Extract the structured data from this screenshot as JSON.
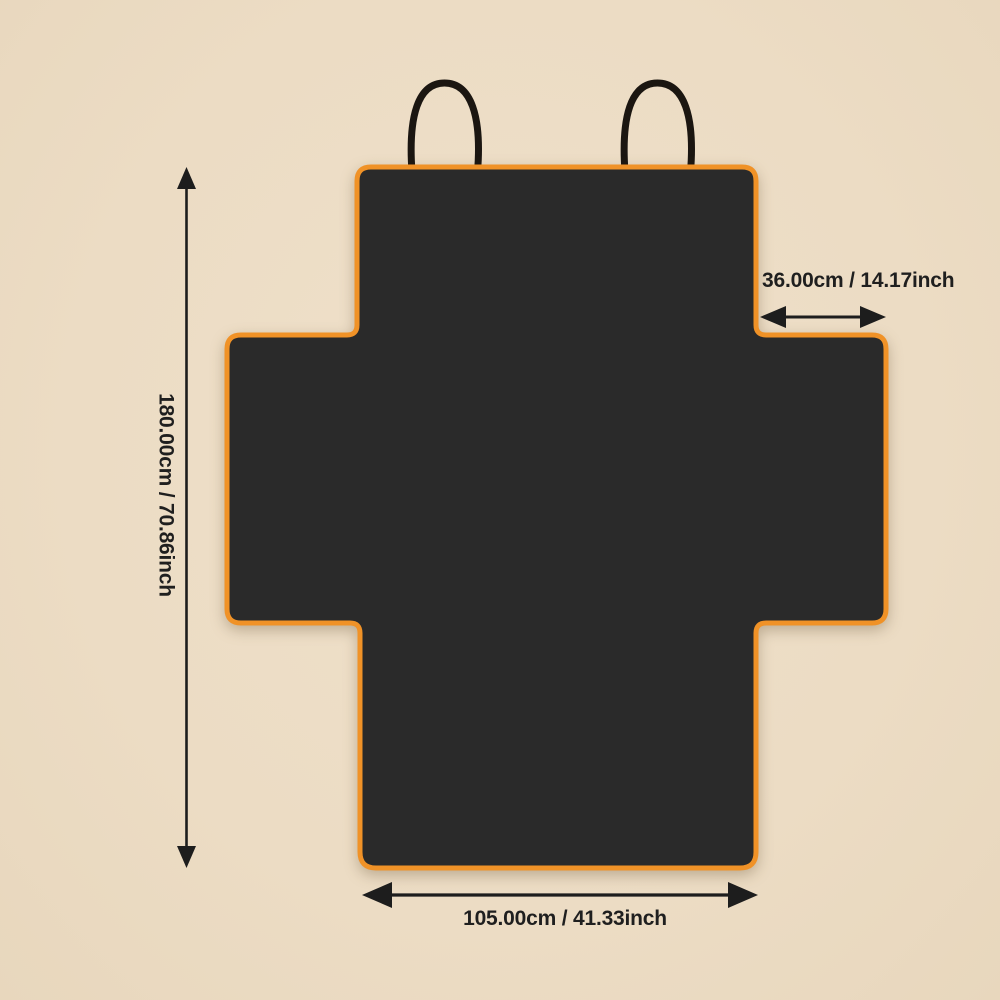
{
  "page": {
    "background_color": "#ecdcc4",
    "content_type": "product-dimension-diagram"
  },
  "product_diagram": {
    "shape": "cross-shaped seat cover with two top hanging loops",
    "straps_count": 2,
    "colors": {
      "cover_fill": "#2a2a2a",
      "trim": "#f09227",
      "strap": "#1b1611",
      "dimension_ink": "#1d1d1d",
      "background": "#ecdcc4"
    }
  },
  "dimensions": {
    "height": {
      "label": "180.00cm / 70.86inch",
      "cm": 180.0,
      "inch": 70.86,
      "orientation": "vertical"
    },
    "side_flap": {
      "label": "36.00cm / 14.17inch",
      "cm": 36.0,
      "inch": 14.17,
      "orientation": "horizontal"
    },
    "bottom_width": {
      "label": "105.00cm / 41.33inch",
      "cm": 105.0,
      "inch": 41.33,
      "orientation": "horizontal"
    }
  },
  "icons": {
    "height_arrow": "double-headed-vertical-arrow",
    "side_flap_arrow": "double-headed-horizontal-arrow",
    "bottom_width_arrow": "double-headed-horizontal-arrow"
  }
}
